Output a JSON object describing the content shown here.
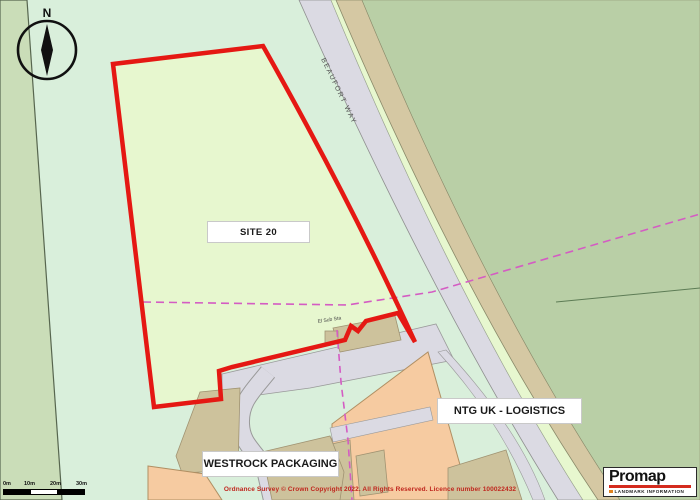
{
  "map": {
    "labels": {
      "site": "SITE 20",
      "ntg": "NTG UK - LOGISTICS",
      "westrock": "WESTROCK PACKAGING",
      "road": "BEAUFORT WAY",
      "substation": "El Sub Sta"
    },
    "compass": {
      "north_label": "N"
    },
    "scale_bar": {
      "ticks": [
        "0m",
        "10m",
        "20m",
        "30m"
      ]
    },
    "copyright": "Ordnance Survey © Crown Copyright 2022. All Rights Reserved. Licence number 100022432",
    "logo": {
      "name": "Promap",
      "subtitle": "LANDMARK INFORMATION"
    },
    "colors": {
      "site_fill": "#e7f7cf",
      "outside_green": "#d9efdb",
      "sage_field": "#b9cfa6",
      "left_strip": "#caddb8",
      "road_gray": "#dbdae3",
      "verge_tan": "#d5c8a3",
      "building_orange": "#f6cba1",
      "building_khaki": "#cdc29c",
      "boundary_red": "#e51813",
      "dashed_magenta": "#d45cc3"
    }
  }
}
